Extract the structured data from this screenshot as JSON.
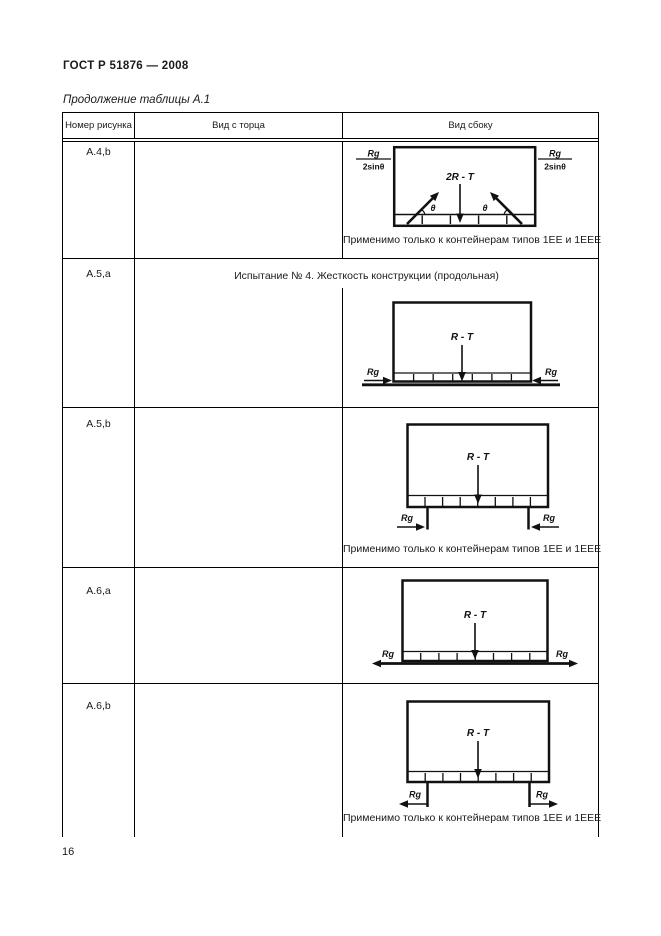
{
  "page": {
    "doc_code": "ГОСТ Р 51876 — 2008",
    "continuation": "Продолжение таблицы А.1",
    "page_number": "16"
  },
  "table": {
    "headers": [
      "Номер рисунка",
      "Вид с торца",
      "Вид сбоку"
    ],
    "rows": [
      {
        "figure": "А.4,b",
        "note": "Применимо только к контейнерам типов 1ЕЕ и 1ЕЕЕ",
        "labels": {
          "force": "2R - T",
          "angle": "θ",
          "frac_num": "Rg",
          "frac_den": "2sinθ"
        }
      },
      {
        "figure": "А.5,а",
        "test_title": "Испытание № 4. Жесткость конструкции (продольная)",
        "labels": {
          "force": "R - T",
          "rg": "Rg"
        }
      },
      {
        "figure": "А.5,b",
        "note": "Применимо только к контейнерам типов 1ЕЕ и 1ЕЕЕ",
        "labels": {
          "force": "R - T",
          "rg": "Rg"
        }
      },
      {
        "figure": "А.6,а",
        "labels": {
          "force": "R - T",
          "rg": "Rg"
        }
      },
      {
        "figure": "А.6,b",
        "note": "Применимо только к контейнерам типов 1ЕЕ и 1ЕЕЕ",
        "labels": {
          "force": "R - T",
          "rg": "Rg"
        }
      }
    ]
  }
}
